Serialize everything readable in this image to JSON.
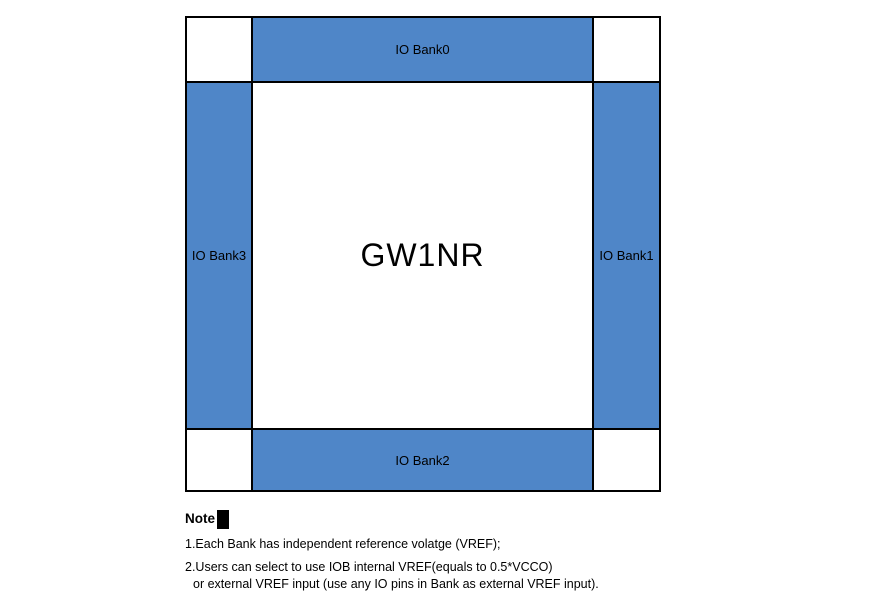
{
  "figure": {
    "center_label": "GW1NR",
    "banks": [
      {
        "id": "bank0",
        "label": "IO Bank0",
        "position": "top"
      },
      {
        "id": "bank1",
        "label": "IO Bank1",
        "position": "right"
      },
      {
        "id": "bank2",
        "label": "IO Bank2",
        "position": "bottom"
      },
      {
        "id": "bank3",
        "label": "IO Bank3",
        "position": "left"
      }
    ],
    "colors": {
      "bank_fill": "#4f86c8",
      "border": "#000000",
      "background": "#ffffff",
      "text": "#000000"
    }
  },
  "notes": {
    "heading": "Note",
    "lines": [
      "1.Each Bank has independent reference volatge (VREF);",
      "2.Users can select to use IOB internal VREF(equals to 0.5*VCCO)",
      "or external VREF input (use any IO pins in Bank as external VREF input)."
    ]
  }
}
